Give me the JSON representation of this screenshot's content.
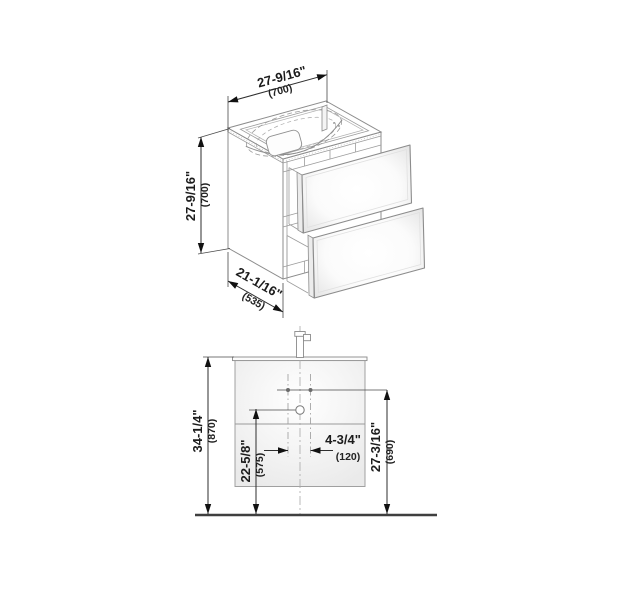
{
  "drawing": {
    "iso_view": {
      "width_in": "27-9/16\"",
      "width_mm": "(700)",
      "height_in": "27-9/16\"",
      "height_mm": "(700)",
      "depth_in": "21-1/16\"",
      "depth_mm": "(535)"
    },
    "front_view": {
      "overall_height_in": "34-1/4\"",
      "overall_height_mm": "(870)",
      "drain_height_in": "22-5/8\"",
      "drain_height_mm": "(575)",
      "hole_spacing_in": "4-3/4\"",
      "hole_spacing_mm": "(120)",
      "side_holes_height_in": "27-3/16\"",
      "side_holes_height_mm": "(690)"
    }
  }
}
